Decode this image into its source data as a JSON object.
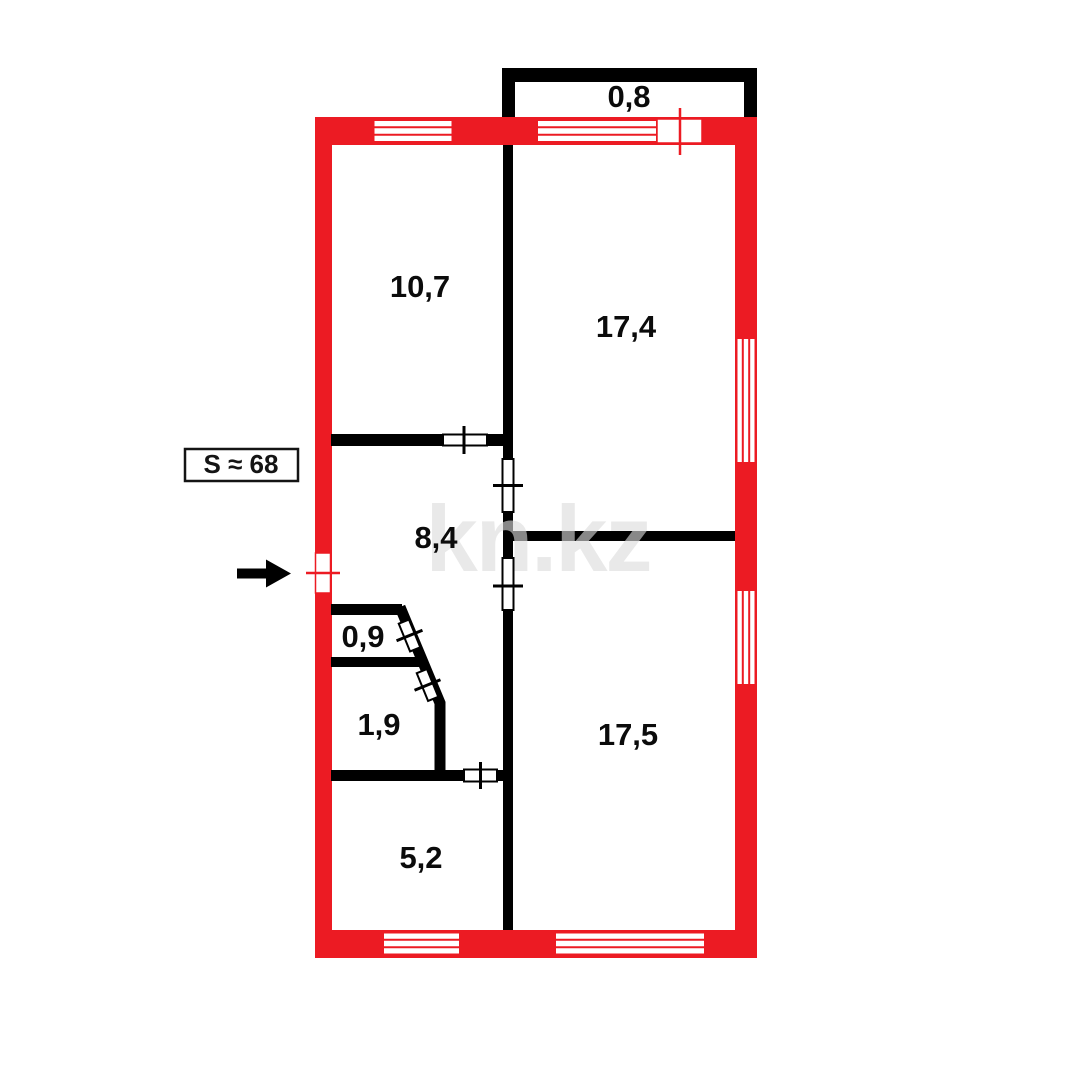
{
  "plan": {
    "watermark_text": "kn.kz",
    "total_area": {
      "label": "S ≈ 68"
    },
    "rooms": {
      "balcony": "0,8",
      "top_left": "10,7",
      "top_right": "17,4",
      "hall": "8,4",
      "wc": "0,9",
      "bathroom": "1,9",
      "kitchen": "5,2",
      "bottom_right": "17,5"
    },
    "colors": {
      "wall_red": "#EC1B23",
      "wall_black": "#000000",
      "watermark_gray": "#DCDCDC"
    }
  }
}
